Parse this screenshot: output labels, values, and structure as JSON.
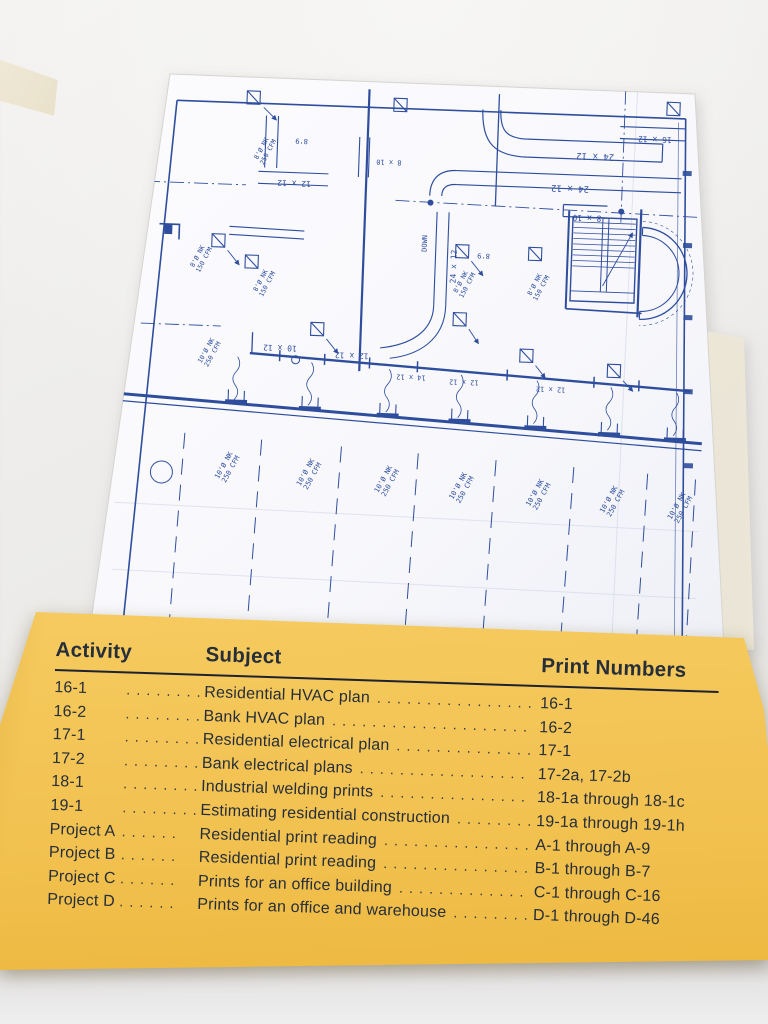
{
  "colors": {
    "card_bg": "#f2c251",
    "card_text": "#262e3a",
    "blueprint_ink": "#2e4e9d",
    "blueprint_paper": "#fafafd"
  },
  "card": {
    "headers": {
      "activity": "Activity",
      "subject": "Subject",
      "prints": "Print Numbers"
    },
    "rows": [
      {
        "activity": "16-1",
        "a_dots": ". . . . . . . . .",
        "subject": "Residential HVAC plan",
        "s_dots": ". . . . . . . . . . . . . . . . . . . . . . . . .",
        "prints": "16-1"
      },
      {
        "activity": "16-2",
        "a_dots": ". . . . . . . . .",
        "subject": "Bank HVAC plan",
        "s_dots": ". . . . . . . . . . . . . . . . . . . . . . . . . . . .",
        "prints": "16-2"
      },
      {
        "activity": "17-1",
        "a_dots": ". . . . . . . . .",
        "subject": "Residential electrical plan",
        "s_dots": ". . . . . . . . . . . . . . . . . . . . . .",
        "prints": "17-1"
      },
      {
        "activity": "17-2",
        "a_dots": ". . . . . . . . .",
        "subject": "Bank electrical plans",
        "s_dots": ". . . . . . . . . . . . . . . . . . . . . . . . .",
        "prints": "17-2a, 17-2b"
      },
      {
        "activity": "18-1",
        "a_dots": ". . . . . . . . .",
        "subject": "Industrial welding prints",
        "s_dots": ". . . . . . . . . . . . . . . . . . . . . .",
        "prints": "18-1a through 18-1c"
      },
      {
        "activity": "19-1",
        "a_dots": ". . . . . . . . .",
        "subject": "Estimating residential construction",
        "s_dots": ". . . . . . . . . . . .",
        "prints": "19-1a through 19-1h"
      },
      {
        "activity": "Project A",
        "a_dots": ". . . . . .",
        "subject": "Residential print reading",
        "s_dots": ". . . . . . . . . . . . . . . . . .",
        "prints": "A-1 through A-9"
      },
      {
        "activity": "Project B",
        "a_dots": ". . . . . .",
        "subject": "Residential print reading",
        "s_dots": ". . . . . . . . . . . . . . . . . .",
        "prints": "B-1 through B-7"
      },
      {
        "activity": "Project C",
        "a_dots": ". . . . . .",
        "subject": "Prints for an office building",
        "s_dots": ". . . . . . . . . . . . . . . .",
        "prints": "C-1 through C-16"
      },
      {
        "activity": "Project D",
        "a_dots": ". . . . . .",
        "subject": "Prints for an office and warehouse",
        "s_dots": ". . . . . . . . . . .",
        "prints": "D-1 through D-46"
      }
    ]
  },
  "blueprint": {
    "description": "HVAC ductwork plan, viewed upside-down",
    "labels": [
      {
        "lines": [
          "24 x 12"
        ],
        "x": 428,
        "y": 64,
        "r": 180,
        "s": 9
      },
      {
        "lines": [
          "24 x 12"
        ],
        "x": 404,
        "y": 97,
        "r": 180,
        "s": 9
      },
      {
        "lines": [
          "16 x 12"
        ],
        "x": 487,
        "y": 45,
        "r": 180,
        "s": 8
      },
      {
        "lines": [
          "8 x 10"
        ],
        "x": 422,
        "y": 126,
        "r": 180,
        "s": 8
      },
      {
        "lines": [
          "12 x 12"
        ],
        "x": 128,
        "y": 102,
        "r": 180,
        "s": 8
      },
      {
        "lines": [
          "8 x 10"
        ],
        "x": 222,
        "y": 78,
        "r": 180,
        "s": 7
      },
      {
        "lines": [
          "10 x 12"
        ],
        "x": 120,
        "y": 267,
        "r": 180,
        "s": 8
      },
      {
        "lines": [
          "12 x 12"
        ],
        "x": 192,
        "y": 272,
        "r": 180,
        "s": 8
      },
      {
        "lines": [
          "14 x 12"
        ],
        "x": 252,
        "y": 292,
        "r": 180,
        "s": 7
      },
      {
        "lines": [
          "12 x 12"
        ],
        "x": 305,
        "y": 295,
        "r": 180,
        "s": 7
      },
      {
        "lines": [
          "12 x 12"
        ],
        "x": 392,
        "y": 299,
        "r": 180,
        "s": 7
      },
      {
        "lines": [
          "24 x 12"
        ],
        "x": 293,
        "y": 182,
        "r": -90,
        "s": 8
      },
      {
        "lines": [
          "DOWN"
        ],
        "x": 263,
        "y": 160,
        "r": -90,
        "s": 7
      },
      {
        "lines": [
          "8'9"
        ],
        "x": 134,
        "y": 60,
        "r": 180,
        "s": 7
      },
      {
        "lines": [
          "8'9"
        ],
        "x": 320,
        "y": 168,
        "r": 180,
        "s": 7
      },
      {
        "lines": [
          "8'Ø NK",
          "250 CFM"
        ],
        "x": 96,
        "y": 72,
        "r": -64,
        "s": 6.5
      },
      {
        "lines": [
          "8'Ø NK",
          "150 CFM"
        ],
        "x": 36,
        "y": 182,
        "r": -64,
        "s": 6.5
      },
      {
        "lines": [
          "8'Ø NK",
          "150 CFM"
        ],
        "x": 100,
        "y": 204,
        "r": -64,
        "s": 6.5
      },
      {
        "lines": [
          "8'Ø NK",
          "150 CFM"
        ],
        "x": 300,
        "y": 198,
        "r": -64,
        "s": 6.5
      },
      {
        "lines": [
          "8'Ø NK",
          "150 CFM"
        ],
        "x": 374,
        "y": 198,
        "r": -64,
        "s": 6.5
      },
      {
        "lines": [
          "10'Ø NK",
          "250 CFM"
        ],
        "x": 48,
        "y": 276,
        "r": -63,
        "s": 6.5
      },
      {
        "lines": [
          "10'Ø NK",
          "250 CFM"
        ],
        "x": 70,
        "y": 390,
        "r": -63,
        "s": 7
      },
      {
        "lines": [
          "10'Ø NK",
          "250 CFM"
        ],
        "x": 152,
        "y": 394,
        "r": -63,
        "s": 7
      },
      {
        "lines": [
          "10'Ø NK",
          "250 CFM"
        ],
        "x": 230,
        "y": 398,
        "r": -63,
        "s": 7
      },
      {
        "lines": [
          "10'Ø NK",
          "250 CFM"
        ],
        "x": 305,
        "y": 402,
        "r": -63,
        "s": 7
      },
      {
        "lines": [
          "10'Ø NK",
          "250 CFM"
        ],
        "x": 382,
        "y": 406,
        "r": -63,
        "s": 7
      },
      {
        "lines": [
          "10'Ø NK",
          "250 CFM"
        ],
        "x": 456,
        "y": 410,
        "r": -63,
        "s": 7
      },
      {
        "lines": [
          "10'Ø NK",
          "250 CFM"
        ],
        "x": 524,
        "y": 414,
        "r": -63,
        "s": 7
      }
    ]
  }
}
